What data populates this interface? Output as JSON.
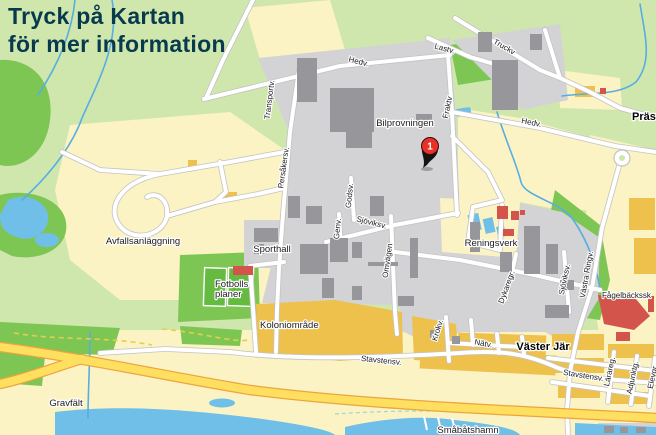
{
  "title": {
    "line1": "Tryck på Kartan",
    "line2": "för mer information"
  },
  "marker": {
    "label": "1"
  },
  "labels": {
    "hedv_w": "Hedv.",
    "lastv": "Lastv.",
    "truckv": "Truckv",
    "transportv": "Transportv.",
    "bilprovningen": "Bilprovningen",
    "fraktv": "Fraktv",
    "hedv_e": "Hedv.",
    "prast": "Präst",
    "persakersv": "Persåkersv.",
    "avfallsanlaggning": "Avfallsanläggning",
    "sporthall": "Sporthall",
    "genv": "Genv.",
    "godsv": "Godsv.",
    "sjoviksv_mid": "Sjöviksv.",
    "omvagen": "Omvägen",
    "reningsverk": "Reningsverk",
    "dykaregr": "Dykaregr.",
    "sjoviksv_s": "Sjöviksv.",
    "vastra_ringv": "Västra Ringv.",
    "fagelbacksskolan": "Fågelbäckssk",
    "fotbolls_line1": "Fotbolls",
    "fotbolls_line2": "planer",
    "koloniomrade": "Koloniområde",
    "krokv": "Krokv.",
    "natv": "Nätv.",
    "vaster_jar": "Väster Jär",
    "stavstensv_w": "Stavstensv.",
    "stavstensv_e": "Stavstensv.",
    "larareg": "Lärareg.",
    "adjunktg": "Adjunktg.",
    "elevgr": "Elevgr",
    "gravfalt": "Gravfält",
    "smabatshamn": "Småbåtshamn"
  },
  "colors": {
    "bg": "#cfe7ad",
    "green_dark": "#7dc654",
    "pitch": "#64bb40",
    "field": "#fbf3c3",
    "industrial": "#d3d3d5",
    "building": "#96969b",
    "water": "#6fbfe9",
    "stream": "#58ade2",
    "road_fill": "#ffffff",
    "road_casing": "#c3c3c3",
    "highway": "#ffdf5f",
    "highway_casing": "#eca43e",
    "orange_block": "#eec14d",
    "red_building": "#d2544b",
    "label": "#1b1b1b",
    "title": "#083a4d",
    "marker_red": "#e63228",
    "marker_dark": "#141414",
    "boundary": "#e3cf4e"
  }
}
